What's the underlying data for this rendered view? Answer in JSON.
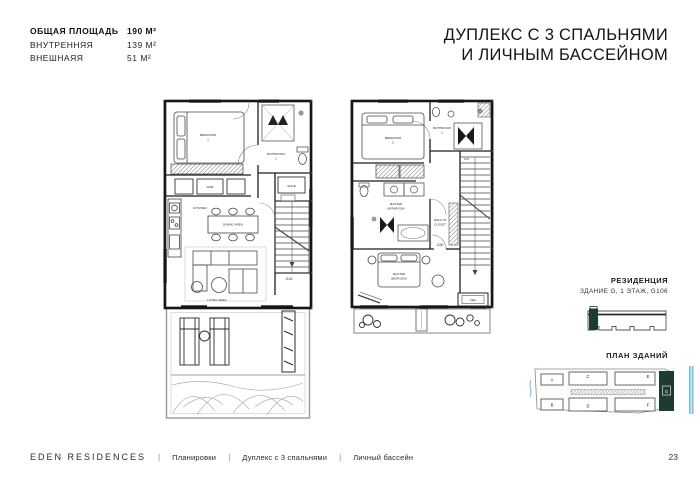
{
  "header": {
    "area_rows": [
      {
        "label": "ОБЩАЯ ПЛОЩАДЬ",
        "value": "190 М²"
      },
      {
        "label": "ВНУТРЕННЯЯ",
        "value": "139 М²"
      },
      {
        "label": "ВНЕШНАЯЯ",
        "value": "51 М²"
      }
    ],
    "title_line1": "ДУПЛЕКС С 3 СПАЛЬНЯМИ",
    "title_line2": "И ЛИЧНЫМ БАССЕЙНОМ"
  },
  "plans": {
    "ground": {
      "bedroom_l1": "BEDROOM",
      "bedroom_l2": "1",
      "bathroom_l1": "BATHROOM",
      "bathroom_l2": "1",
      "shoe": "SHOE",
      "wine": "WINE",
      "kitchen": "KITCHEN",
      "dining": "DINING AREA",
      "living": "LIVING AREA",
      "dimension": "1100"
    },
    "upper": {
      "bedroom_l1": "BEDROOM",
      "bedroom_l2": "2",
      "bathroom_l1": "BATHROOM",
      "bathroom_l2": "2",
      "down": "DN.",
      "master_bath_l1": "MASTER",
      "master_bath_l2": "BATHROOM",
      "walkin_l1": "WALK-IN",
      "walkin_l2": "CLOSET",
      "master_bed_l1": "MASTER",
      "master_bed_l2": "BEDROOM",
      "vrv": "VRV",
      "dimension": "1100"
    }
  },
  "residence": {
    "heading": "РЕЗИДЕНЦИЯ",
    "subheading": "ЗДАНИЕ G, 1 ЭТАЖ, G106"
  },
  "site": {
    "heading": "ПЛАН ЗДАНИЙ",
    "buildings": {
      "a": "A",
      "b": "B",
      "c": "C",
      "d": "D",
      "e": "E",
      "f": "F",
      "g": "G"
    },
    "highlight_color": "#1e3b31",
    "water_color": "#7cc0df"
  },
  "footer": {
    "brand": "EDEN RESIDENCES",
    "items": [
      "Планировки",
      "Дуплекс с 3 спальнями",
      "Личный бассейн"
    ],
    "page_number": "23"
  }
}
